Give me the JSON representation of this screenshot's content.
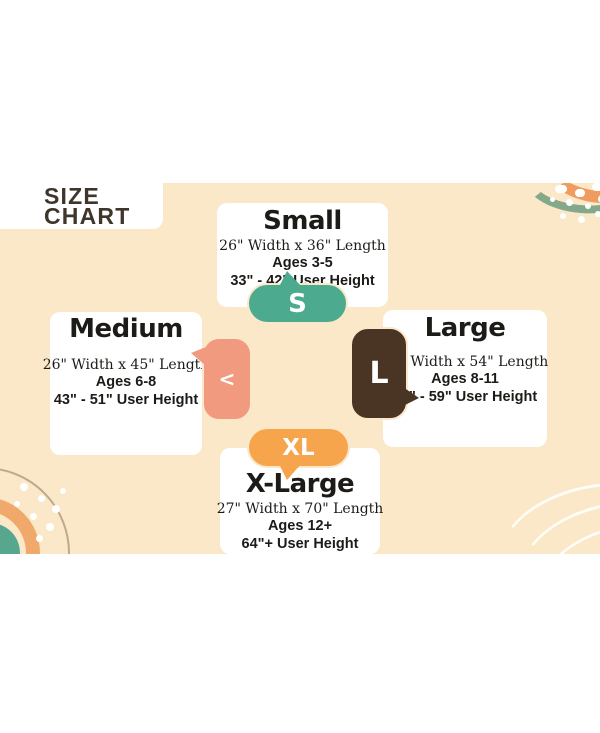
{
  "title": {
    "line1": "SIZE",
    "line2": "CHART"
  },
  "colors": {
    "canvas": "#fae8c9",
    "heading": "#3e352b",
    "card": "#ffffff",
    "text": "#1d1b17",
    "small_badge": "#4caa8f",
    "medium_badge": "#f19a80",
    "large_badge": "#4a3525",
    "xlarge_badge": "#f6a54d"
  },
  "sizes": [
    {
      "name": "Small",
      "dimensions": "26\" Width x 36\" Length",
      "ages": "Ages 3-5",
      "user_height": "33\" - 42\" User Height",
      "badge": "S"
    },
    {
      "name": "Medium",
      "dimensions": "26\" Width x 45\" Length",
      "ages": "Ages 6-8",
      "user_height": "43\" - 51\" User Height",
      "badge": "<"
    },
    {
      "name": "Large",
      "dimensions": "26\" Width x 54\" Length",
      "ages": "Ages 8-11",
      "user_height": "52\" - 59\" User Height",
      "badge": "L"
    },
    {
      "name": "X-Large",
      "dimensions": "27\" Width x 70\" Length",
      "ages": "Ages 12+",
      "user_height": "64\"+ User Height",
      "badge": "XL"
    }
  ]
}
